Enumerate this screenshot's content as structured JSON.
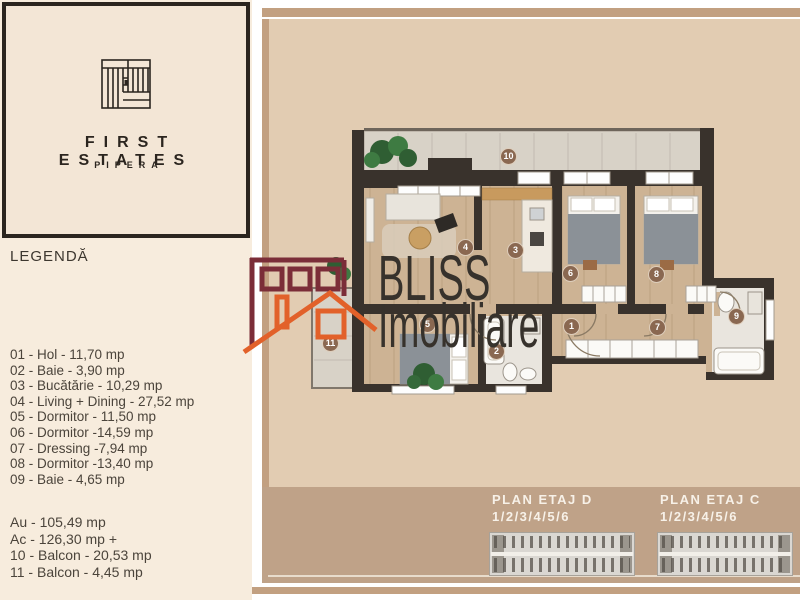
{
  "branding": {
    "title": "FIRST ESTATES",
    "subtitle": "PIPERA"
  },
  "legend": {
    "title": "LEGENDĂ",
    "items": [
      "01 - Hol - 11,70 mp",
      "02 - Baie - 3,90 mp",
      "03 - Bucătărie - 10,29 mp",
      "04 - Living + Dining - 27,52 mp",
      "05 - Dormitor - 11,50 mp",
      "06 - Dormitor -14,59 mp",
      "07 - Dressing -7,94 mp",
      "08 - Dormitor -13,40 mp",
      "09 - Baie - 4,65 mp"
    ],
    "totals": [
      "Au - 105,49 mp",
      "Ac - 126,30 mp +",
      "10 - Balcon - 20,53 mp",
      "11 - Balcon - 4,45 mp"
    ]
  },
  "watermark": {
    "line1": "BLISS",
    "line2": "Imobiliare"
  },
  "floorplan": {
    "room_labels": [
      {
        "num": "1",
        "x": 572,
        "y": 327
      },
      {
        "num": "2",
        "x": 497,
        "y": 352
      },
      {
        "num": "3",
        "x": 516,
        "y": 251
      },
      {
        "num": "4",
        "x": 466,
        "y": 248
      },
      {
        "num": "5",
        "x": 428,
        "y": 325
      },
      {
        "num": "6",
        "x": 571,
        "y": 274
      },
      {
        "num": "7",
        "x": 658,
        "y": 328
      },
      {
        "num": "8",
        "x": 657,
        "y": 275
      },
      {
        "num": "9",
        "x": 737,
        "y": 317
      },
      {
        "num": "10",
        "x": 509,
        "y": 157
      },
      {
        "num": "11",
        "x": 331,
        "y": 344
      }
    ]
  },
  "footer_plans": [
    {
      "title": "PLAN ETAJ D",
      "levels": "1/2/3/4/5/6"
    },
    {
      "title": "PLAN ETAJ C",
      "levels": "1/2/3/4/5/6"
    }
  ],
  "colors": {
    "accent_maroon": "#7b2d38",
    "accent_orange": "#e2612a",
    "panel": "#e2ccb2",
    "panel_dark": "#bfa288",
    "wall": "#39322c",
    "wood": "#cdb394",
    "badge": "#8a6851"
  }
}
